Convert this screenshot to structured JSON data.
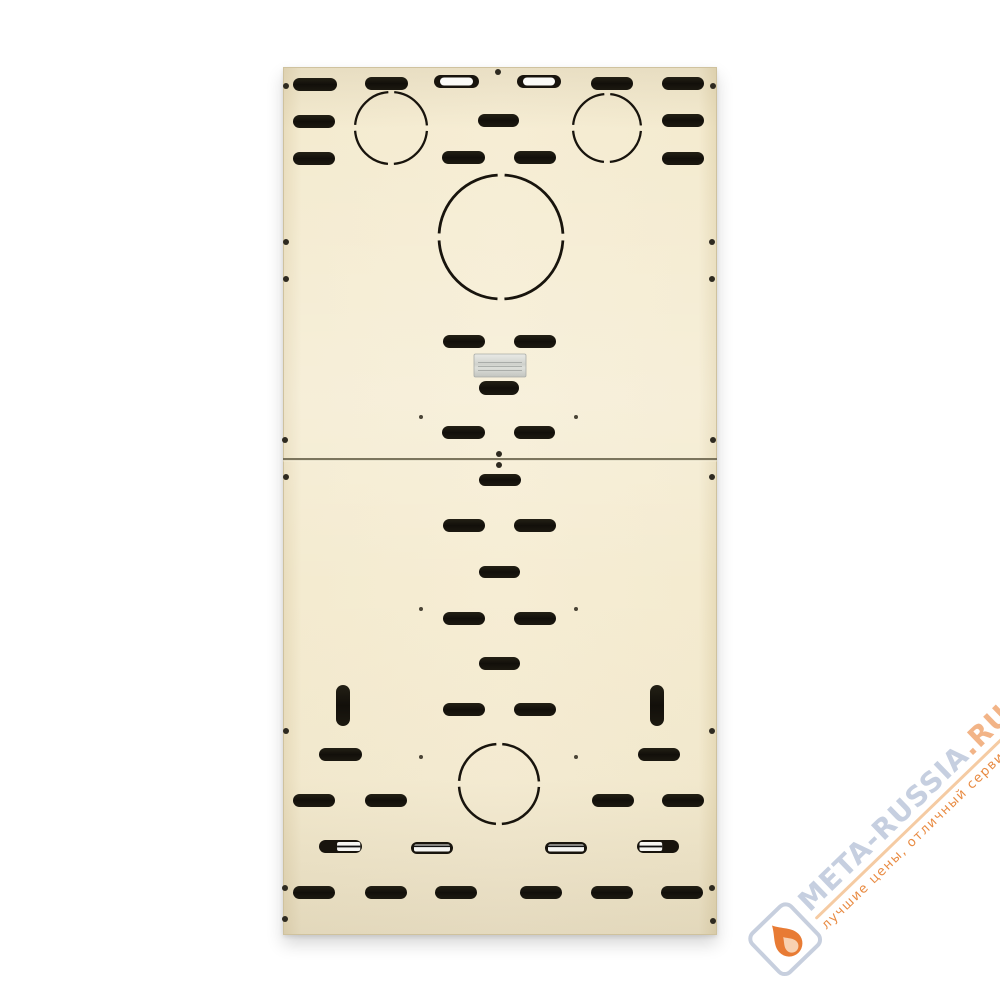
{
  "watermark": {
    "site": "META-RUSSIA",
    "tld": ".RU",
    "tagline": "лучшие цены, отличный сервис!",
    "site_color": "#c4cedf",
    "tld_color": "#f2b183",
    "tagline_color": "#e8873c",
    "underline_color": "#f5c9a0",
    "logo_border_color": "#c5cedd",
    "flame_color": "#e8762c",
    "flame_inner_color": "#f8d0ae",
    "rotation_deg": -44
  },
  "panel": {
    "x": 283,
    "y": 67,
    "width": 434,
    "height": 868,
    "seam_y": 458,
    "panel_color": "#f5ecd2",
    "edge_color": "#cfc29e",
    "cutout_color": "#18140d",
    "seam_color": "#6e6750",
    "hole_color": "#2e2a20",
    "tiny_hole_color": "#4a4436",
    "slots": [
      [
        293,
        78,
        44,
        13
      ],
      [
        365,
        77,
        43,
        13
      ],
      [
        591,
        77,
        42,
        13
      ],
      [
        662,
        77,
        42,
        13
      ],
      [
        293,
        115,
        42,
        13
      ],
      [
        478,
        114,
        41,
        13
      ],
      [
        662,
        114,
        42,
        13
      ],
      [
        293,
        152,
        42,
        13
      ],
      [
        442,
        151,
        43,
        13
      ],
      [
        514,
        151,
        42,
        13
      ],
      [
        662,
        152,
        42,
        13
      ],
      [
        443,
        335,
        42,
        13
      ],
      [
        514,
        335,
        42,
        13
      ],
      [
        479,
        381,
        40,
        14
      ],
      [
        442,
        426,
        43,
        13
      ],
      [
        514,
        426,
        41,
        13
      ],
      [
        479,
        474,
        42,
        12
      ],
      [
        443,
        519,
        42,
        13
      ],
      [
        514,
        519,
        42,
        13
      ],
      [
        479,
        566,
        41,
        12
      ],
      [
        443,
        612,
        42,
        13
      ],
      [
        514,
        612,
        42,
        13
      ],
      [
        479,
        657,
        41,
        13
      ],
      [
        443,
        703,
        42,
        13
      ],
      [
        514,
        703,
        42,
        13
      ],
      [
        319,
        748,
        43,
        13
      ],
      [
        638,
        748,
        42,
        13
      ],
      [
        293,
        794,
        42,
        13
      ],
      [
        365,
        794,
        42,
        13
      ],
      [
        592,
        794,
        42,
        13
      ],
      [
        662,
        794,
        42,
        13
      ],
      [
        293,
        886,
        42,
        13
      ],
      [
        365,
        886,
        42,
        13
      ],
      [
        435,
        886,
        42,
        13
      ],
      [
        520,
        886,
        42,
        13
      ],
      [
        591,
        886,
        42,
        13
      ],
      [
        661,
        886,
        42,
        13
      ]
    ],
    "bright_slots": [
      [
        434,
        75,
        45,
        13
      ],
      [
        517,
        75,
        44,
        13
      ]
    ],
    "metal_slots": [
      [
        319,
        840,
        43,
        13,
        "right"
      ],
      [
        411,
        842,
        42,
        12,
        "full"
      ],
      [
        545,
        842,
        42,
        12,
        "full"
      ],
      [
        637,
        840,
        42,
        13,
        "left"
      ]
    ],
    "vertical_slots": [
      [
        336,
        685,
        14,
        41
      ],
      [
        650,
        685,
        14,
        41
      ]
    ],
    "knockout_circles": [
      {
        "cx": 391,
        "cy": 128,
        "r": 36,
        "sw": 2.3
      },
      {
        "cx": 607,
        "cy": 128,
        "r": 34,
        "sw": 2.3
      },
      {
        "cx": 501,
        "cy": 237,
        "r": 62,
        "sw": 2.8
      },
      {
        "cx": 499,
        "cy": 784,
        "r": 40,
        "sw": 2.5
      }
    ],
    "holes": [
      [
        286,
        86
      ],
      [
        713,
        86
      ],
      [
        286,
        242
      ],
      [
        286,
        279
      ],
      [
        712,
        242
      ],
      [
        712,
        279
      ],
      [
        285,
        440
      ],
      [
        713,
        440
      ],
      [
        286,
        477
      ],
      [
        712,
        477
      ],
      [
        286,
        731
      ],
      [
        712,
        731
      ],
      [
        285,
        888
      ],
      [
        712,
        888
      ],
      [
        285,
        919
      ],
      [
        713,
        921
      ],
      [
        498,
        72
      ],
      [
        499,
        454
      ],
      [
        499,
        465
      ]
    ],
    "tiny_holes": [
      [
        421,
        417
      ],
      [
        576,
        417
      ],
      [
        421,
        609
      ],
      [
        576,
        609
      ],
      [
        421,
        757
      ],
      [
        576,
        757
      ]
    ],
    "label": {
      "x": 474,
      "y": 354,
      "w": 52,
      "h": 23
    }
  }
}
